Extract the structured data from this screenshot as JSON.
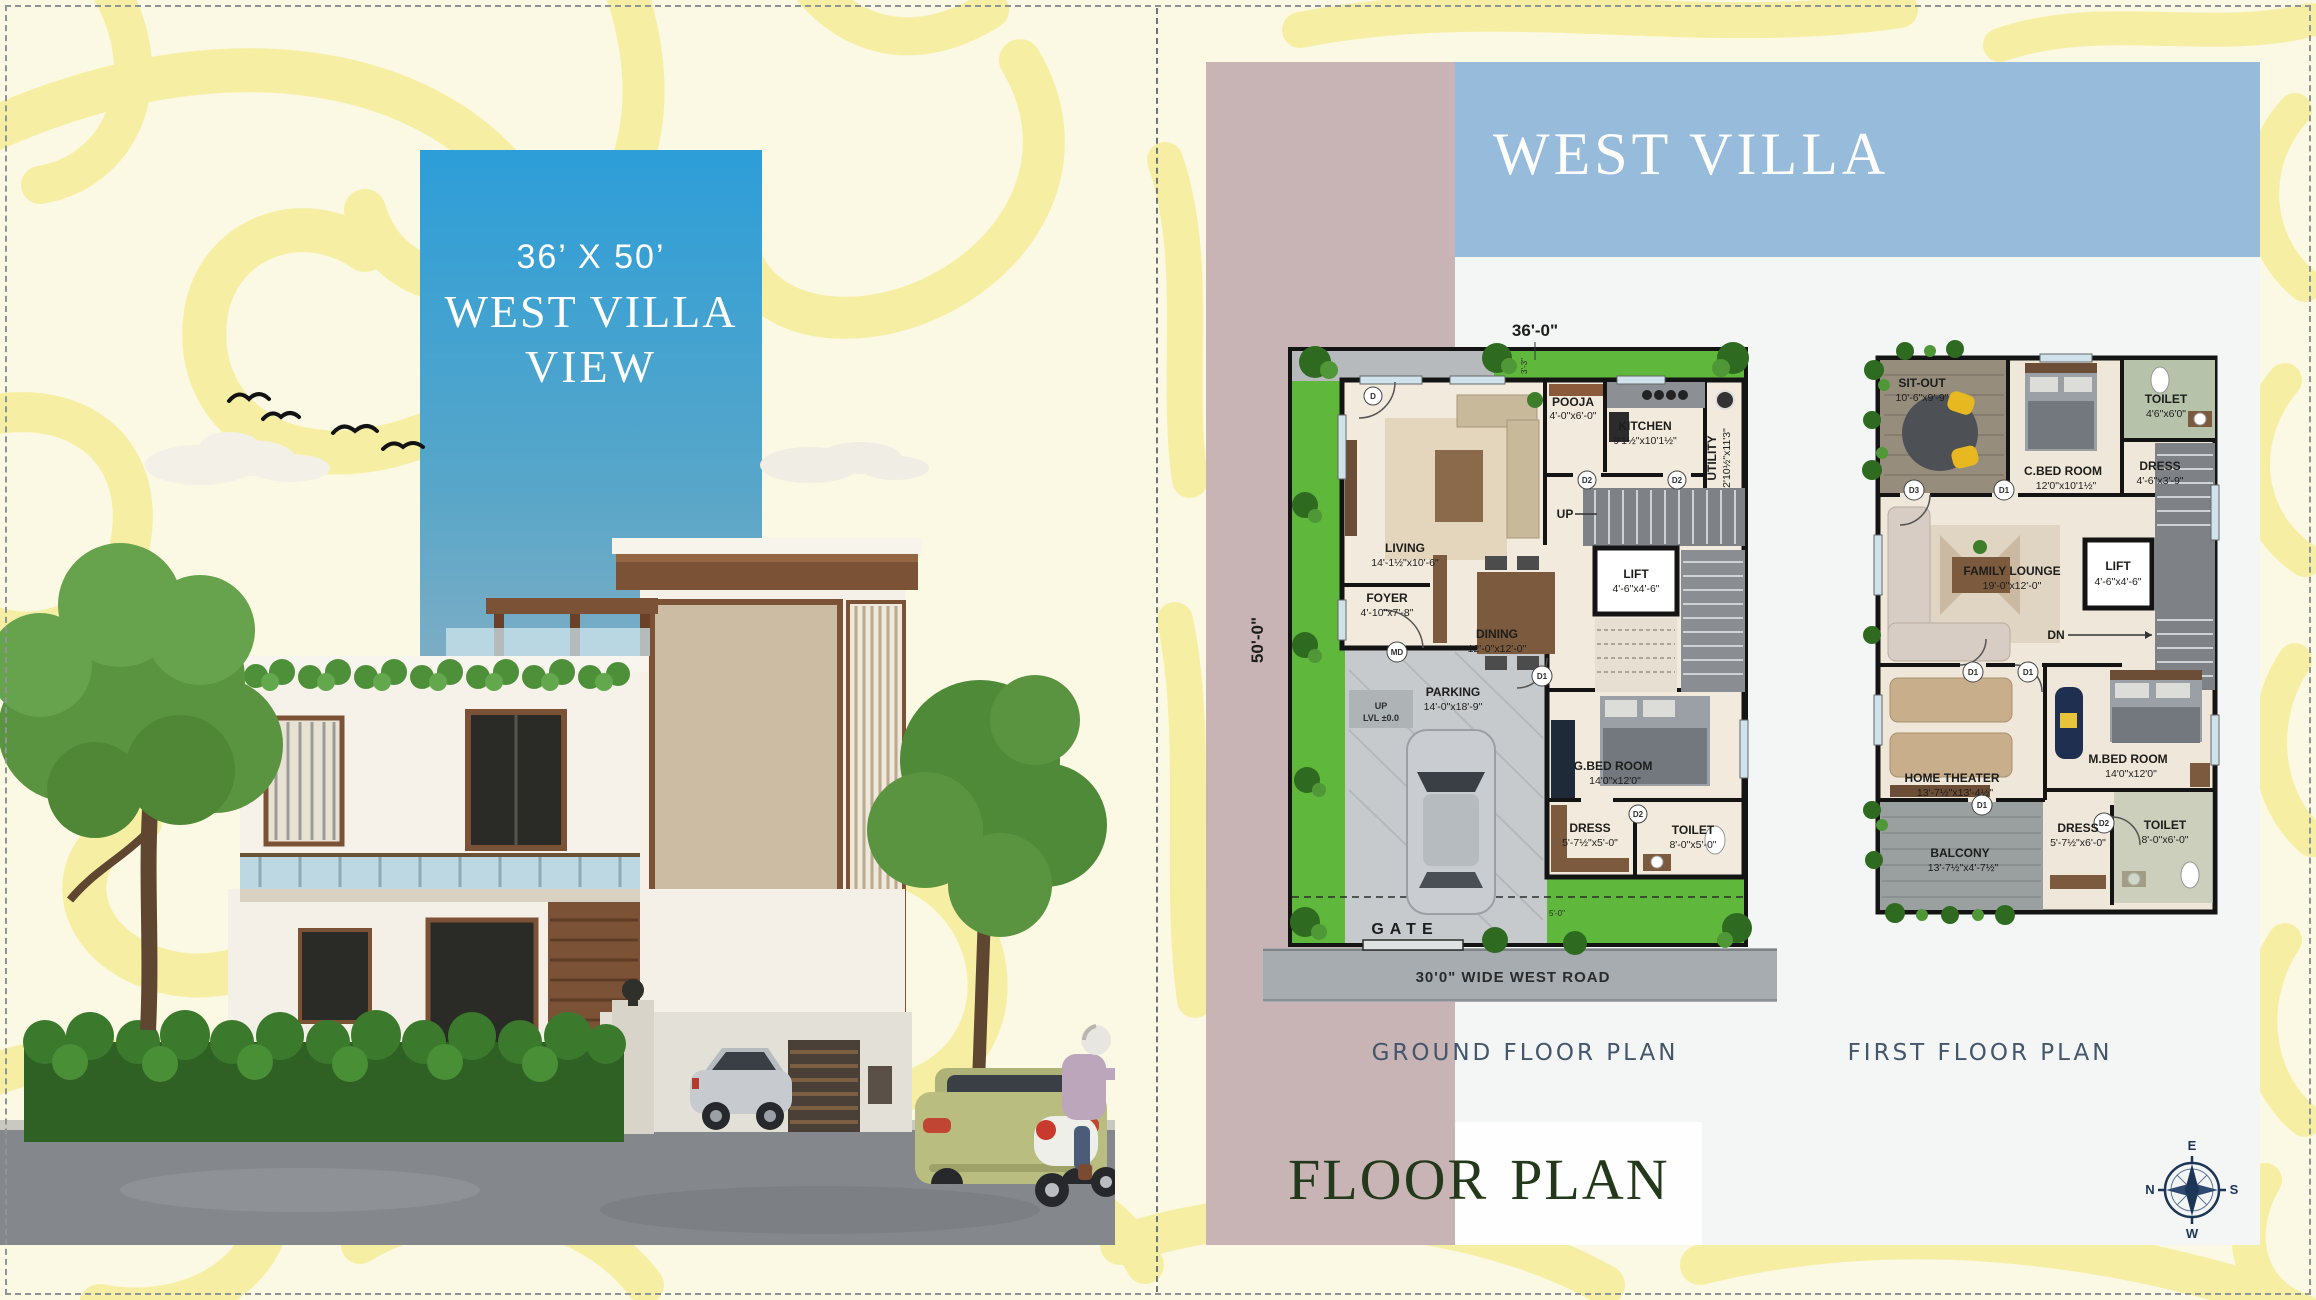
{
  "left_page": {
    "view_box": {
      "size_label": "36’ X 50’",
      "title": "WEST VILLA",
      "subtitle": "VIEW"
    }
  },
  "right_page": {
    "header_title": "WEST VILLA",
    "footer": {
      "floor_word": "FLOOR",
      "plan_word": "PLAN"
    },
    "compass": {
      "e": "E",
      "n": "N",
      "s": "S",
      "w": "W"
    },
    "ground_floor": {
      "caption": "GROUND FLOOR PLAN",
      "width_dim": "36'-0\"",
      "depth_dim": "50'-0\"",
      "garden_dim": "3'-3\"",
      "setback_dim": "5'-0\"",
      "road_label": "30'0\" WIDE WEST ROAD",
      "gate_label": "GATE",
      "up_stairs_label": "UP",
      "up_ramp_label": "UP",
      "level_label": "LVL ±0.0",
      "rooms": [
        {
          "name": "LIVING",
          "dims": "14'-1½\"x10'-6\""
        },
        {
          "name": "POOJA",
          "dims": "4'-0\"x6'-0\""
        },
        {
          "name": "KITCHEN",
          "dims": "9'1½\"x10'1½\""
        },
        {
          "name": "UTILITY",
          "dims": "2'10½\"x11'3\""
        },
        {
          "name": "LIFT",
          "dims": "4'-6\"x4'-6\""
        },
        {
          "name": "FOYER",
          "dims": "4'-10\"x7'-8\""
        },
        {
          "name": "DINING",
          "dims": "12'-0\"x12'-0\""
        },
        {
          "name": "PARKING",
          "dims": "14'-0\"x18'-9\""
        },
        {
          "name": "G.BED ROOM",
          "dims": "14'0\"x12'0\""
        },
        {
          "name": "DRESS",
          "dims": "5'-7½\"x5'-0\""
        },
        {
          "name": "TOILET",
          "dims": "8'-0\"x5'-0\""
        }
      ],
      "doors": {
        "living": "D",
        "kitchen_a": "D2",
        "kitchen_b": "D2",
        "main": "MD",
        "bedroom": "D1",
        "toilet": "D2"
      }
    },
    "first_floor": {
      "caption": "FIRST FLOOR PLAN",
      "dn_label": "DN",
      "rooms": [
        {
          "name": "SIT-OUT",
          "dims": "10'-6\"x9'-9\""
        },
        {
          "name": "C.BED ROOM",
          "dims": "12'0\"x10'1½\""
        },
        {
          "name": "TOILET",
          "dims": "4'6\"x6'0\""
        },
        {
          "name": "DRESS",
          "dims": "4'-6\"x3'-9\""
        },
        {
          "name": "FAMILY LOUNGE",
          "dims": "19'-0\"x12'-0\""
        },
        {
          "name": "LIFT",
          "dims": "4'-6\"x4'-6\""
        },
        {
          "name": "HOME THEATER",
          "dims": "13'-7½\"x13'-4½\""
        },
        {
          "name": "M.BED ROOM",
          "dims": "14'0\"x12'0\""
        },
        {
          "name": "BALCONY",
          "dims": "13'-7½\"x4'-7½\""
        },
        {
          "name": "DRESS",
          "dims": "5'-7½\"x6'-0\""
        },
        {
          "name": "TOILET",
          "dims": "8'-0\"x6'-0\""
        }
      ],
      "doors": {
        "sitout": "D3",
        "cbed": "D1",
        "lounge_a": "D1",
        "lounge_b": "D1",
        "balcony": "D1",
        "toilet": "D2"
      }
    }
  },
  "colors": {
    "background_cream": "#FBF8E3",
    "squiggle_yellow": "#F6EFA3",
    "mauve_panel": "#C9B4B5",
    "blue_band": "#96BBDB",
    "content_gray": "#F4F6F5",
    "sign_blue_top": "#2D9ED8",
    "sign_blue_bottom": "#9FB9C7",
    "title_green": "#24391B",
    "caption_blue": "#44566B",
    "lawn_green": "#5FB83C",
    "road_gray": "#A7ACB0",
    "wall_black": "#141414",
    "compass_navy": "#1D3557"
  }
}
